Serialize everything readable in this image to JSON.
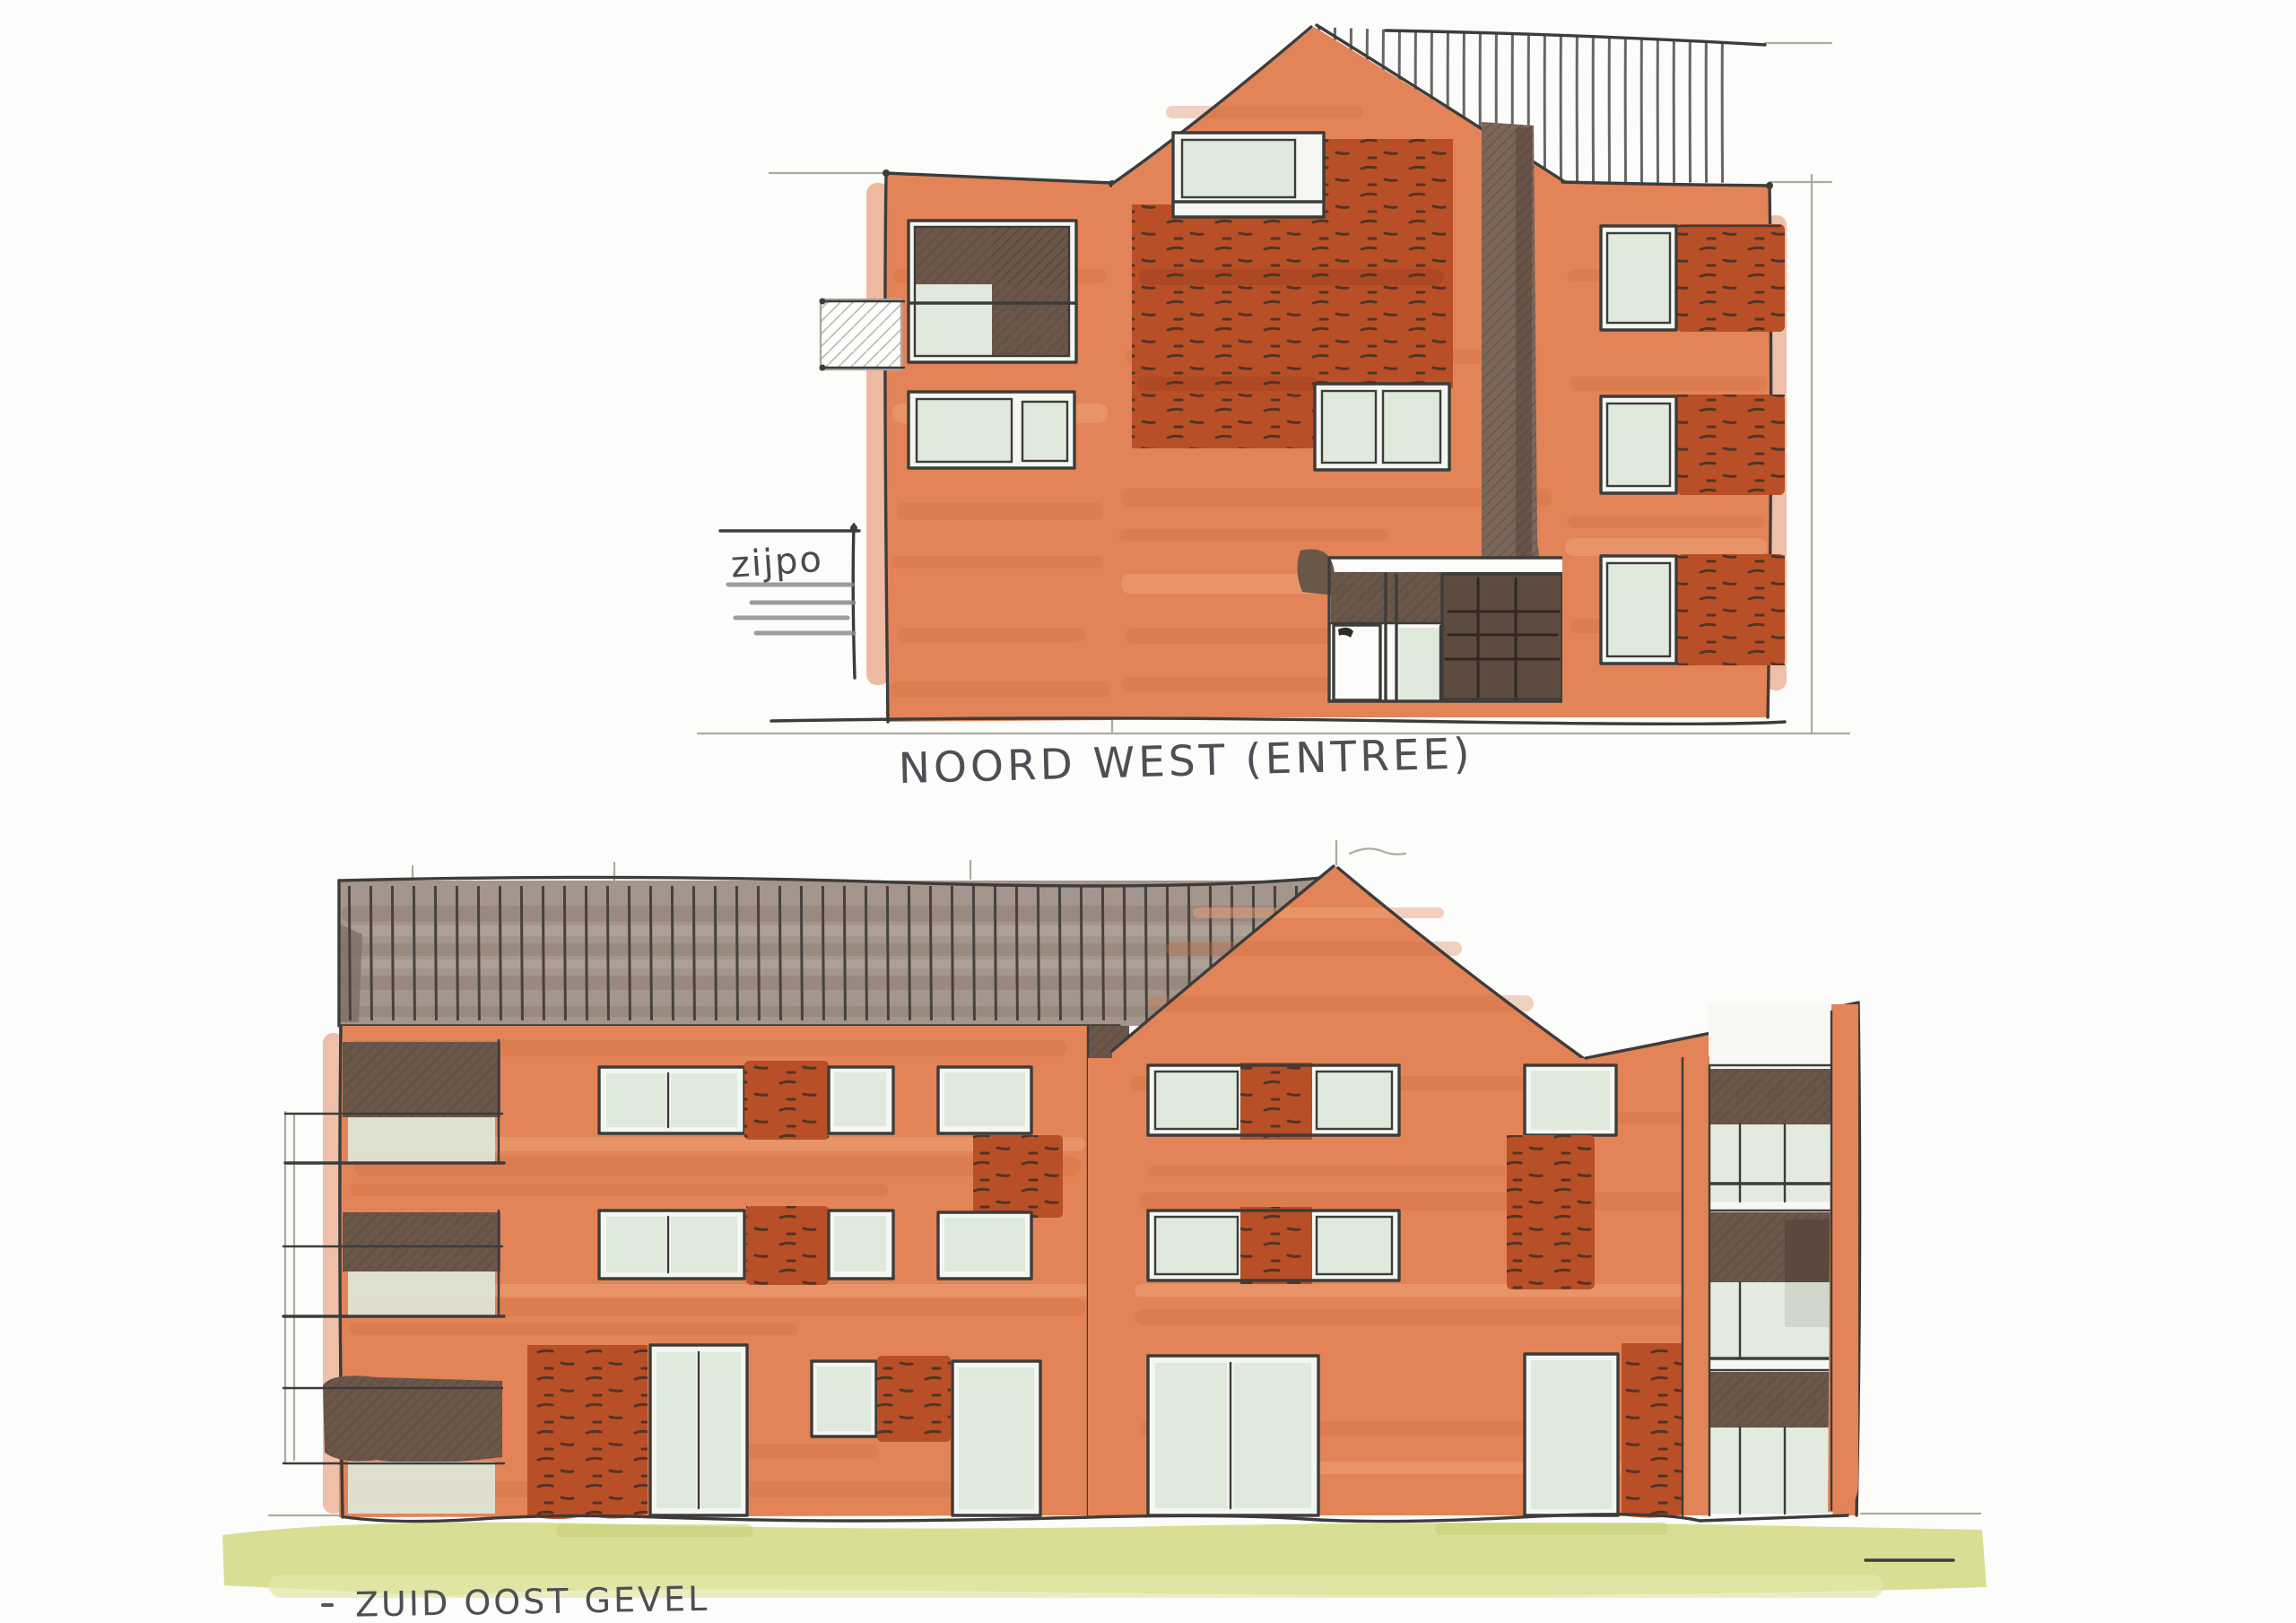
{
  "document": {
    "kind": "hand-drawn architectural elevation sketch",
    "media": "marker and ink on white paper",
    "building_floors": 3
  },
  "palette": {
    "paper": "#FCFCFB",
    "facade_salmon": "#E28457",
    "brick_red": "#B94F27",
    "dark_brown": "#6B564A",
    "roof_taupe": "#A5968D",
    "glass_green": "#DFE9DC",
    "grass_green": "#D8DC8E",
    "ink_pen": "#3D3C3A",
    "pencil_gray": "#ACA9A4"
  },
  "drawings": [
    {
      "id": "noord-west-entree",
      "caption": "NOORD WEST (ENTREE)",
      "building_name_inscription": "NAAM",
      "margin_note": "zijpo",
      "position": "top"
    },
    {
      "id": "zuid-oost-gevel",
      "caption": "ZUID OOST GEVEL",
      "position": "bottom"
    }
  ]
}
